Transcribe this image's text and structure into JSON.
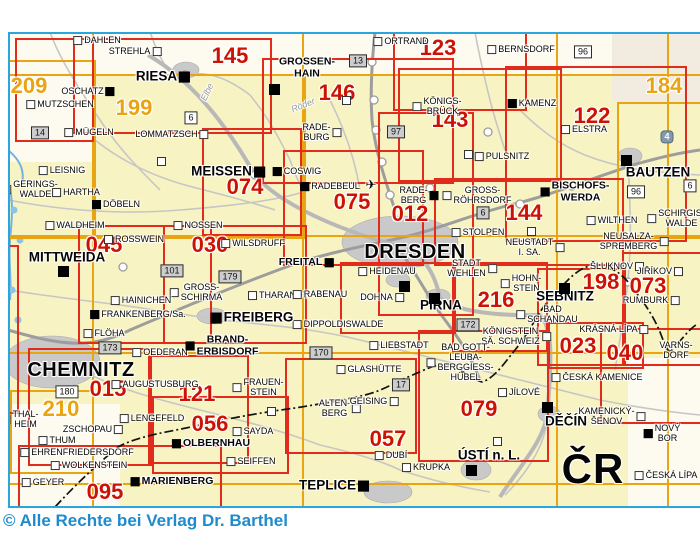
{
  "copyright": "© Alle Rechte bei Verlag Dr. Barthel",
  "colors": {
    "frame_blue": "#2aa5de",
    "copyright_blue": "#1e8bcd",
    "sheet_red": "#e02b1d",
    "number_red": "#cc1205",
    "sheet_orange": "#e8a413",
    "map_yellow": "#f8f3c2",
    "map_offwhite": "#fdfbf0",
    "map_graybeige": "#f2ebe0",
    "road_gray": "#b3b3b3",
    "urban_gray": "#c9c9c9",
    "water_blue": "#74b3e0"
  },
  "map": {
    "country_border_note": "dash-dot Czech border",
    "patches": [
      {
        "x": 8,
        "y": 32,
        "w": 692,
        "h": 44,
        "c": "map_offwhite"
      },
      {
        "x": 8,
        "y": 32,
        "w": 88,
        "h": 130,
        "c": "map_offwhite"
      },
      {
        "x": 612,
        "y": 32,
        "w": 88,
        "h": 70,
        "c": "map_graybeige"
      },
      {
        "x": 8,
        "y": 404,
        "w": 112,
        "h": 104,
        "c": "map_offwhite"
      },
      {
        "x": 628,
        "y": 358,
        "w": 72,
        "h": 150,
        "c": "map_offwhite"
      }
    ],
    "grid": {
      "h_lines": [
        74,
        235,
        352,
        483
      ],
      "v_lines": [
        92,
        302,
        556,
        667
      ]
    },
    "gold_rects": [
      {
        "x": 92,
        "y": 74,
        "w": 210,
        "h": 161
      },
      {
        "x": 617,
        "y": 102,
        "w": 150,
        "h": 133
      },
      {
        "x": 10,
        "y": 390,
        "w": 80,
        "h": 80
      },
      {
        "x": -30,
        "y": 60,
        "w": 122,
        "h": 175
      }
    ],
    "sheet_rects": [
      {
        "x": 15,
        "y": 38,
        "w": 75,
        "h": 100
      },
      {
        "x": 73,
        "y": 38,
        "w": 195,
        "h": 92
      },
      {
        "x": 393,
        "y": 31,
        "w": 130,
        "h": 76
      },
      {
        "x": 262,
        "y": 58,
        "w": 188,
        "h": 122
      },
      {
        "x": 398,
        "y": 68,
        "w": 160,
        "h": 110
      },
      {
        "x": 505,
        "y": 66,
        "w": 178,
        "h": 172
      },
      {
        "x": 202,
        "y": 128,
        "w": 96,
        "h": 104
      },
      {
        "x": 283,
        "y": 150,
        "w": 137,
        "h": 112
      },
      {
        "x": 378,
        "y": 112,
        "w": 92,
        "h": 200
      },
      {
        "x": 434,
        "y": 178,
        "w": 186,
        "h": 84
      },
      {
        "x": 78,
        "y": 225,
        "w": 130,
        "h": 115
      },
      {
        "x": 163,
        "y": 225,
        "w": 140,
        "h": 115
      },
      {
        "x": -50,
        "y": 245,
        "w": 65,
        "h": 165
      },
      {
        "x": 340,
        "y": 262,
        "w": 112,
        "h": 68
      },
      {
        "x": 452,
        "y": 262,
        "w": 92,
        "h": 86
      },
      {
        "x": 537,
        "y": 268,
        "w": 85,
        "h": 94
      },
      {
        "x": 622,
        "y": 252,
        "w": 78,
        "h": 110
      },
      {
        "x": 548,
        "y": 322,
        "w": 92,
        "h": 43
      },
      {
        "x": 600,
        "y": 328,
        "w": 100,
        "h": 92
      },
      {
        "x": 148,
        "y": 355,
        "w": 97,
        "h": 105
      },
      {
        "x": 28,
        "y": 348,
        "w": 120,
        "h": 114
      },
      {
        "x": 152,
        "y": 396,
        "w": 133,
        "h": 74
      },
      {
        "x": 285,
        "y": 358,
        "w": 128,
        "h": 92
      },
      {
        "x": 418,
        "y": 330,
        "w": 127,
        "h": 128
      },
      {
        "x": 18,
        "y": 445,
        "w": 200,
        "h": 60
      }
    ],
    "sheets": [
      {
        "num": "145",
        "x": 230,
        "y": 56,
        "c": "r"
      },
      {
        "num": "123",
        "x": 438,
        "y": 48,
        "c": "r"
      },
      {
        "num": "146",
        "x": 337,
        "y": 93,
        "c": "r"
      },
      {
        "num": "143",
        "x": 450,
        "y": 120,
        "c": "r"
      },
      {
        "num": "122",
        "x": 592,
        "y": 116,
        "c": "r"
      },
      {
        "num": "184",
        "x": 664,
        "y": 86,
        "c": "o"
      },
      {
        "num": "209",
        "x": 29,
        "y": 86,
        "c": "o"
      },
      {
        "num": "199",
        "x": 134,
        "y": 108,
        "c": "o"
      },
      {
        "num": "074",
        "x": 245,
        "y": 187,
        "c": "r"
      },
      {
        "num": "075",
        "x": 352,
        "y": 202,
        "c": "r"
      },
      {
        "num": "012",
        "x": 410,
        "y": 214,
        "c": "r"
      },
      {
        "num": "144",
        "x": 524,
        "y": 213,
        "c": "r"
      },
      {
        "num": "045",
        "x": 104,
        "y": 245,
        "c": "r"
      },
      {
        "num": "030",
        "x": 210,
        "y": 245,
        "c": "r"
      },
      {
        "num": "216",
        "x": 496,
        "y": 300,
        "c": "r"
      },
      {
        "num": "198",
        "x": 601,
        "y": 282,
        "c": "r"
      },
      {
        "num": "073",
        "x": 648,
        "y": 286,
        "c": "r"
      },
      {
        "num": "023",
        "x": 578,
        "y": 346,
        "c": "r"
      },
      {
        "num": "040",
        "x": 625,
        "y": 353,
        "c": "r"
      },
      {
        "num": "121",
        "x": 197,
        "y": 394,
        "c": "r"
      },
      {
        "num": "015",
        "x": 108,
        "y": 389,
        "c": "r"
      },
      {
        "num": "210",
        "x": 61,
        "y": 409,
        "c": "o"
      },
      {
        "num": "056",
        "x": 210,
        "y": 424,
        "c": "r"
      },
      {
        "num": "057",
        "x": 388,
        "y": 439,
        "c": "r"
      },
      {
        "num": "079",
        "x": 479,
        "y": 409,
        "c": "r"
      },
      {
        "num": "095",
        "x": 105,
        "y": 492,
        "c": "r"
      }
    ],
    "places": [
      {
        "t": "DAHLEN",
        "x": 97,
        "y": 41,
        "s": "sm",
        "m": "wl"
      },
      {
        "t": "STREHLA",
        "x": 135,
        "y": 52,
        "s": "sm",
        "m": "wr"
      },
      {
        "t": "OSCHATZ",
        "x": 88,
        "y": 92,
        "s": "sm",
        "m": "br"
      },
      {
        "t": "MUTZSCHEN",
        "x": 60,
        "y": 105,
        "s": "sm",
        "m": "wl"
      },
      {
        "t": "MÜGELN",
        "x": 89,
        "y": 133,
        "s": "sm",
        "m": "wl"
      },
      {
        "t": "LOMMATZSCH",
        "x": 172,
        "y": 135,
        "s": "sm",
        "m": "wr"
      },
      {
        "t": "LEISNIG",
        "x": 62,
        "y": 171,
        "s": "sm",
        "m": "wl"
      },
      {
        "t": "GERINGS-\nWALDE",
        "x": 30,
        "y": 190,
        "s": "sm",
        "m": "wl"
      },
      {
        "t": "HARTHA",
        "x": 76,
        "y": 193,
        "s": "sm",
        "m": "wl"
      },
      {
        "t": "DÖBELN",
        "x": 116,
        "y": 205,
        "s": "sm",
        "m": "bl"
      },
      {
        "t": "WALDHEIM",
        "x": 75,
        "y": 226,
        "s": "sm",
        "m": "wl"
      },
      {
        "t": "NOSSEN",
        "x": 198,
        "y": 226,
        "s": "sm",
        "m": "wl"
      },
      {
        "t": "ROSSWEIN",
        "x": 134,
        "y": 240,
        "s": "sm",
        "m": "wl"
      },
      {
        "t": "ORTRAND",
        "x": 401,
        "y": 42,
        "s": "sm",
        "m": "wl"
      },
      {
        "t": "BERNSDORF",
        "x": 521,
        "y": 50,
        "s": "sm",
        "m": "wl"
      },
      {
        "t": "KÖNIGS-\nBRÜCK",
        "x": 437,
        "y": 107,
        "s": "sm",
        "m": "wl"
      },
      {
        "t": "KAMENZ",
        "x": 532,
        "y": 104,
        "s": "sm",
        "m": "bl"
      },
      {
        "t": "ELSTRA",
        "x": 584,
        "y": 130,
        "s": "sm",
        "m": "wl"
      },
      {
        "t": "PULSNITZ",
        "x": 502,
        "y": 157,
        "s": "sm",
        "m": "wl"
      },
      {
        "t": "GROSS-\nRÖHRSDORF",
        "x": 477,
        "y": 196,
        "s": "sm",
        "m": "wl"
      },
      {
        "t": "RADE-\nBURG",
        "x": 322,
        "y": 133,
        "s": "sm",
        "m": "wr"
      },
      {
        "t": "COSWIG",
        "x": 297,
        "y": 172,
        "s": "sm",
        "m": "bl"
      },
      {
        "t": "RADEBEUL",
        "x": 330,
        "y": 187,
        "s": "sm",
        "m": "bl"
      },
      {
        "t": "RADE-\nBERG",
        "x": 419,
        "y": 196,
        "s": "sm",
        "m": "br"
      },
      {
        "t": "STOLPEN",
        "x": 478,
        "y": 233,
        "s": "sm",
        "m": "wl"
      },
      {
        "t": "NEUSTADT\nI. SA.",
        "x": 535,
        "y": 248,
        "s": "sm",
        "m": "wr"
      },
      {
        "t": "BISCHOFS-\nWERDA",
        "x": 575,
        "y": 192,
        "s": "b1",
        "m": "bl"
      },
      {
        "t": "WILTHEN",
        "x": 612,
        "y": 221,
        "s": "sm",
        "m": "wl"
      },
      {
        "t": "SCHIRGIS-\nWALDE",
        "x": 676,
        "y": 219,
        "s": "sm",
        "m": "wl"
      },
      {
        "t": "NEUSALZA-\nSPREMBERG",
        "x": 634,
        "y": 242,
        "s": "sm",
        "m": "wr"
      },
      {
        "t": "ŠLUKNOV",
        "x": 617,
        "y": 267,
        "s": "sm",
        "m": "wr"
      },
      {
        "t": "JIŘÍKOV",
        "x": 660,
        "y": 272,
        "s": "sm",
        "m": "wr"
      },
      {
        "t": "RUMBURK",
        "x": 651,
        "y": 301,
        "s": "sm",
        "m": "wr"
      },
      {
        "t": "KRÁSNÁ LÍPA",
        "x": 614,
        "y": 330,
        "s": "sm",
        "m": "wr"
      },
      {
        "t": "VARNS-\nDORF",
        "x": 676,
        "y": 351,
        "s": "sm",
        "m": ""
      },
      {
        "t": "ČESKÁ KAMENICE",
        "x": 597,
        "y": 378,
        "s": "sm",
        "m": "wl"
      },
      {
        "t": "WILSDRUFF",
        "x": 253,
        "y": 244,
        "s": "sm",
        "m": "wl"
      },
      {
        "t": "FREITAL",
        "x": 306,
        "y": 263,
        "s": "b1",
        "m": "br"
      },
      {
        "t": "THARANDT",
        "x": 278,
        "y": 296,
        "s": "sm",
        "m": "wl"
      },
      {
        "t": "RABENAU",
        "x": 320,
        "y": 295,
        "s": "sm",
        "m": "wl"
      },
      {
        "t": "GROSS-\nSCHIRMA",
        "x": 196,
        "y": 293,
        "s": "sm",
        "m": "wl"
      },
      {
        "t": "HAINICHEN",
        "x": 141,
        "y": 301,
        "s": "sm",
        "m": "wl"
      },
      {
        "t": "FRANKENBERG/Sa.",
        "x": 138,
        "y": 315,
        "s": "sm",
        "m": "bl"
      },
      {
        "t": "FLÖHA",
        "x": 104,
        "y": 334,
        "s": "sm",
        "m": "wl"
      },
      {
        "t": "OEDERAN",
        "x": 160,
        "y": 353,
        "s": "sm",
        "m": "wl"
      },
      {
        "t": "AUGUSTUSBURG",
        "x": 155,
        "y": 385,
        "s": "sm",
        "m": "wl"
      },
      {
        "t": "HEIDENAU",
        "x": 387,
        "y": 272,
        "s": "sm",
        "m": "wl"
      },
      {
        "t": "DOHNA",
        "x": 382,
        "y": 298,
        "s": "sm",
        "m": "wr"
      },
      {
        "t": "STADT\nWEHLEN",
        "x": 472,
        "y": 269,
        "s": "sm",
        "m": "wr"
      },
      {
        "t": "HOHN-\nSTEIN",
        "x": 521,
        "y": 284,
        "s": "sm",
        "m": "wl"
      },
      {
        "t": "BAD\nSCHANDAU",
        "x": 547,
        "y": 315,
        "s": "sm",
        "m": "wl"
      },
      {
        "t": "KÖNIGSTEIN\nSÄ. SCHWEIZ",
        "x": 516,
        "y": 337,
        "s": "sm",
        "m": "wr"
      },
      {
        "t": "LIEBSTADT",
        "x": 399,
        "y": 346,
        "s": "sm",
        "m": "wl"
      },
      {
        "t": "BAD GOTT-\nLEUBA-\nBERGGIESS-\nHÜBEL",
        "x": 460,
        "y": 363,
        "s": "sm",
        "m": "wl"
      },
      {
        "t": "GLASHÜTTE",
        "x": 369,
        "y": 370,
        "s": "sm",
        "m": "wl"
      },
      {
        "t": "DIPPOLDISWALDE",
        "x": 338,
        "y": 325,
        "s": "sm",
        "m": "wl"
      },
      {
        "t": "ALTEN-\nBERG",
        "x": 340,
        "y": 409,
        "s": "sm",
        "m": "wr"
      },
      {
        "t": "GEISING",
        "x": 374,
        "y": 402,
        "s": "sm",
        "m": "wr"
      },
      {
        "t": "DUBÍ",
        "x": 391,
        "y": 456,
        "s": "sm",
        "m": "wl"
      },
      {
        "t": "KRUPKA",
        "x": 426,
        "y": 468,
        "s": "sm",
        "m": "wl"
      },
      {
        "t": "FRAUEN-\nSTEIN",
        "x": 258,
        "y": 388,
        "s": "sm",
        "m": "wl"
      },
      {
        "t": "BRAND-\nERBISDORF",
        "x": 222,
        "y": 346,
        "s": "b1",
        "m": "bl"
      },
      {
        "t": "OLBERNHAU",
        "x": 211,
        "y": 444,
        "s": "b1",
        "m": "bl"
      },
      {
        "t": "SAYDA",
        "x": 253,
        "y": 432,
        "s": "sm",
        "m": "wl"
      },
      {
        "t": "SEIFFEN",
        "x": 251,
        "y": 462,
        "s": "sm",
        "m": "wl"
      },
      {
        "t": "ZSCHOPAU",
        "x": 93,
        "y": 430,
        "s": "sm",
        "m": "wr"
      },
      {
        "t": "LENGEFELD",
        "x": 152,
        "y": 419,
        "s": "sm",
        "m": "wl"
      },
      {
        "t": "THAL-\nHEIM",
        "x": 20,
        "y": 420,
        "s": "sm",
        "m": "wl"
      },
      {
        "t": "THUM",
        "x": 57,
        "y": 441,
        "s": "sm",
        "m": "wl"
      },
      {
        "t": "EHRENFRIEDERSDORF",
        "x": 77,
        "y": 453,
        "s": "sm",
        "m": "wl"
      },
      {
        "t": "WOLKENSTEIN",
        "x": 89,
        "y": 466,
        "s": "sm",
        "m": "wl"
      },
      {
        "t": "GEYER",
        "x": 43,
        "y": 483,
        "s": "sm",
        "m": "wl"
      },
      {
        "t": "MARIENBERG",
        "x": 172,
        "y": 482,
        "s": "b1",
        "m": "bl"
      },
      {
        "t": "JÍLOVÉ",
        "x": 519,
        "y": 393,
        "s": "sm",
        "m": "wl"
      },
      {
        "t": "KAMENICKÝ-\nŠENOV",
        "x": 612,
        "y": 417,
        "s": "sm",
        "m": "wr"
      },
      {
        "t": "ČESKÁ LÍPA",
        "x": 666,
        "y": 476,
        "s": "sm",
        "m": "wl"
      },
      {
        "t": "NOVÝ\nBOR",
        "x": 662,
        "y": 434,
        "s": "sm",
        "m": "bl"
      },
      {
        "t": "RIESA",
        "x": 163,
        "y": 77,
        "s": "md",
        "m": "br"
      },
      {
        "t": "GROSSEN-\nHAIN",
        "x": 307,
        "y": 68,
        "s": "b1",
        "m": ""
      },
      {
        "t": "MEISSEN",
        "x": 228,
        "y": 172,
        "s": "md",
        "m": "br"
      },
      {
        "t": "DRESDEN",
        "x": 415,
        "y": 252,
        "s": "lg",
        "m": ""
      },
      {
        "t": "BAUTZEN",
        "x": 658,
        "y": 173,
        "s": "md",
        "m": ""
      },
      {
        "t": "MITTWEIDA",
        "x": 67,
        "y": 258,
        "s": "md",
        "m": ""
      },
      {
        "t": "FREIBERG",
        "x": 252,
        "y": 318,
        "s": "md",
        "m": "bl"
      },
      {
        "t": "PIRNA",
        "x": 441,
        "y": 306,
        "s": "md",
        "m": ""
      },
      {
        "t": "SEBNITZ",
        "x": 565,
        "y": 297,
        "s": "md",
        "m": ""
      },
      {
        "t": "CHEMNITZ",
        "x": 81,
        "y": 370,
        "s": "lg",
        "m": ""
      },
      {
        "t": "DĚČÍN",
        "x": 566,
        "y": 422,
        "s": "md",
        "m": ""
      },
      {
        "t": "TEPLICE",
        "x": 334,
        "y": 486,
        "s": "md",
        "m": "br"
      },
      {
        "t": "ÚSTÍ n. L.",
        "x": 489,
        "y": 456,
        "s": "md",
        "m": ""
      },
      {
        "t": "ČR",
        "x": 593,
        "y": 469,
        "s": "xl",
        "m": ""
      }
    ],
    "marks": [
      {
        "x": 273,
        "y": 88,
        "t": "b"
      },
      {
        "x": 625,
        "y": 159,
        "t": "b"
      },
      {
        "x": 62,
        "y": 270,
        "t": "b"
      },
      {
        "x": 433,
        "y": 297,
        "t": "b"
      },
      {
        "x": 563,
        "y": 287,
        "t": "b"
      },
      {
        "x": 546,
        "y": 406,
        "t": "b"
      },
      {
        "x": 470,
        "y": 469,
        "t": "b"
      },
      {
        "x": 403,
        "y": 285,
        "t": "b"
      },
      {
        "x": 345,
        "y": 99,
        "t": "w"
      },
      {
        "x": 467,
        "y": 153,
        "t": "w"
      },
      {
        "x": 160,
        "y": 160,
        "t": "w"
      },
      {
        "x": 530,
        "y": 230,
        "t": "w"
      },
      {
        "x": 270,
        "y": 410,
        "t": "w"
      },
      {
        "x": 496,
        "y": 440,
        "t": "w"
      }
    ],
    "road_boxes": [
      {
        "n": "13",
        "x": 358,
        "y": 61,
        "s": "g"
      },
      {
        "n": "97",
        "x": 396,
        "y": 132,
        "s": "g"
      },
      {
        "n": "96",
        "x": 583,
        "y": 52,
        "s": "w"
      },
      {
        "n": "96",
        "x": 636,
        "y": 192,
        "s": "w"
      },
      {
        "n": "6",
        "x": 191,
        "y": 118,
        "s": "w"
      },
      {
        "n": "6",
        "x": 483,
        "y": 213,
        "s": "g"
      },
      {
        "n": "6",
        "x": 690,
        "y": 186,
        "s": "w"
      },
      {
        "n": "14",
        "x": 40,
        "y": 133,
        "s": "g"
      },
      {
        "n": "101",
        "x": 172,
        "y": 271,
        "s": "g"
      },
      {
        "n": "179",
        "x": 230,
        "y": 277,
        "s": "g"
      },
      {
        "n": "173",
        "x": 110,
        "y": 348,
        "s": "g"
      },
      {
        "n": "180",
        "x": 67,
        "y": 392,
        "s": "w"
      },
      {
        "n": "170",
        "x": 321,
        "y": 353,
        "s": "g"
      },
      {
        "n": "172",
        "x": 468,
        "y": 325,
        "s": "g"
      },
      {
        "n": "17",
        "x": 401,
        "y": 385,
        "s": "g"
      },
      {
        "n": "4",
        "x": 667,
        "y": 137,
        "s": "m"
      }
    ],
    "river_labels": [
      {
        "t": "Elbe",
        "x": 207,
        "y": 92,
        "rot": -65
      },
      {
        "t": "Röder",
        "x": 303,
        "y": 105,
        "rot": -22
      }
    ],
    "symbols": [
      {
        "t": "✈",
        "x": 371,
        "y": 185,
        "name": "airport-icon"
      }
    ]
  }
}
